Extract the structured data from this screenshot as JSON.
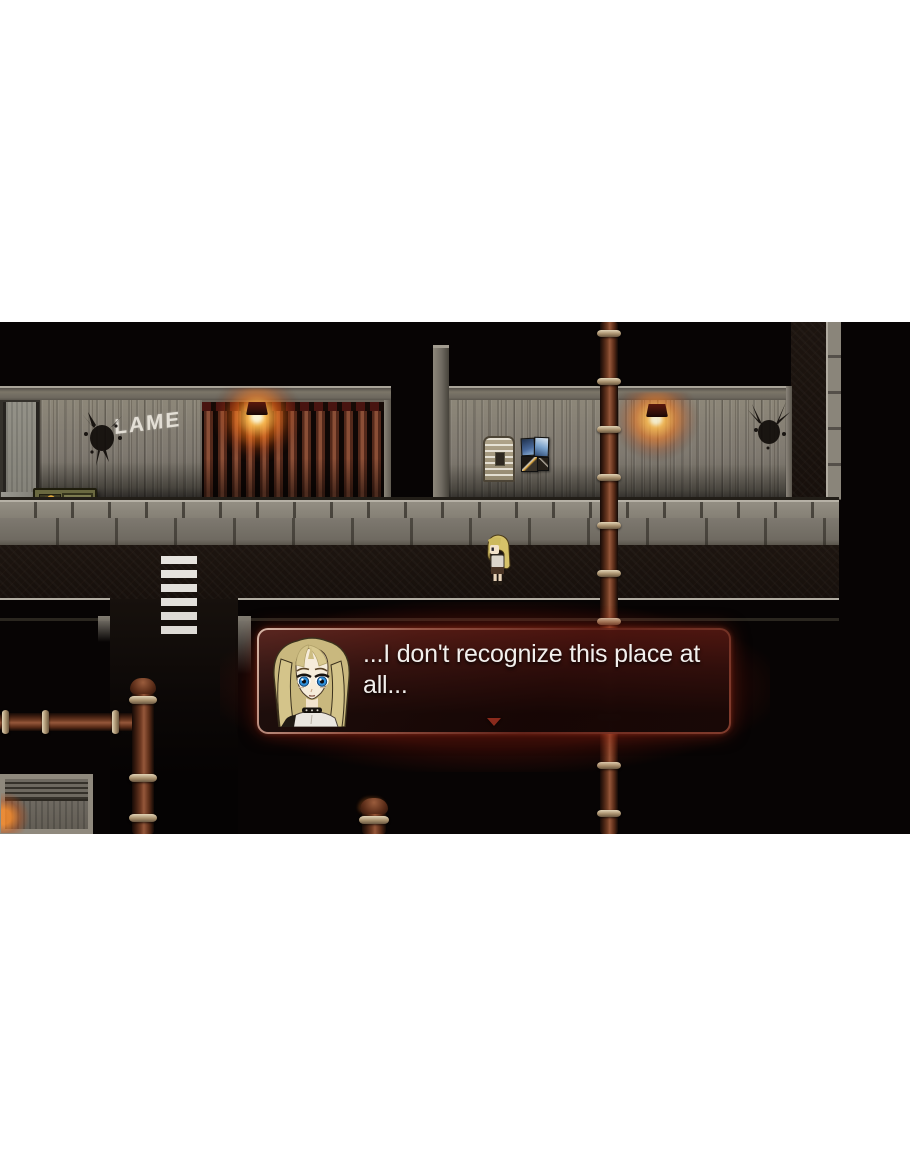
{
  "scene": {
    "graffiti_text": "LAME",
    "objects": [
      "left-building",
      "slat-fence",
      "wall-lamp",
      "vending-machine",
      "right-building",
      "bulletin-board",
      "posters",
      "crosswalk",
      "sidewalk",
      "pipes",
      "shed",
      "rachel-sprite"
    ]
  },
  "dialog": {
    "portrait": "rachel-portrait",
    "line1": "...I don't recognize this place at",
    "line2": "all...",
    "continue_indicator": "down-arrow"
  },
  "palette": {
    "page_bg": "#ffffff",
    "game_bg": "#070404",
    "wall": "#867f73",
    "fence": "#6e3a28",
    "lamp_glow": "#ffa030",
    "pipe": "#6b3a22",
    "crosswalk": "#e6e3de",
    "dialog_border": "#cfa89c",
    "dialog_bg": "#2a0907",
    "dialog_text": "#f2efec"
  }
}
